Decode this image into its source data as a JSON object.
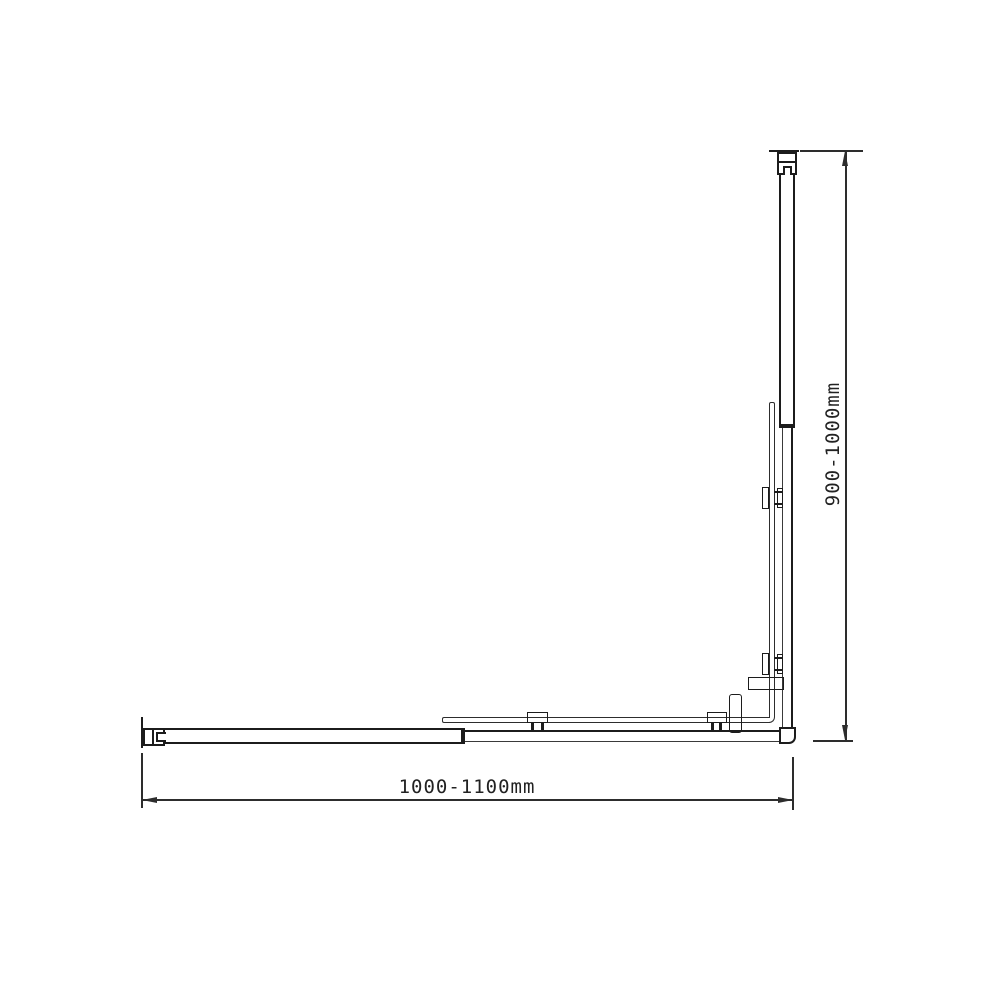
{
  "diagram": {
    "type": "technical-dimension-drawing",
    "labels": {
      "dim_horizontal": "1000-1100mm",
      "dim_vertical": "900-1000mm"
    },
    "colors": {
      "background": "#ffffff",
      "profile_line": "#1c1c1c",
      "glass_line": "#2d2d2d",
      "dimension_line": "#2d2d2d",
      "text": "#222222"
    }
  }
}
